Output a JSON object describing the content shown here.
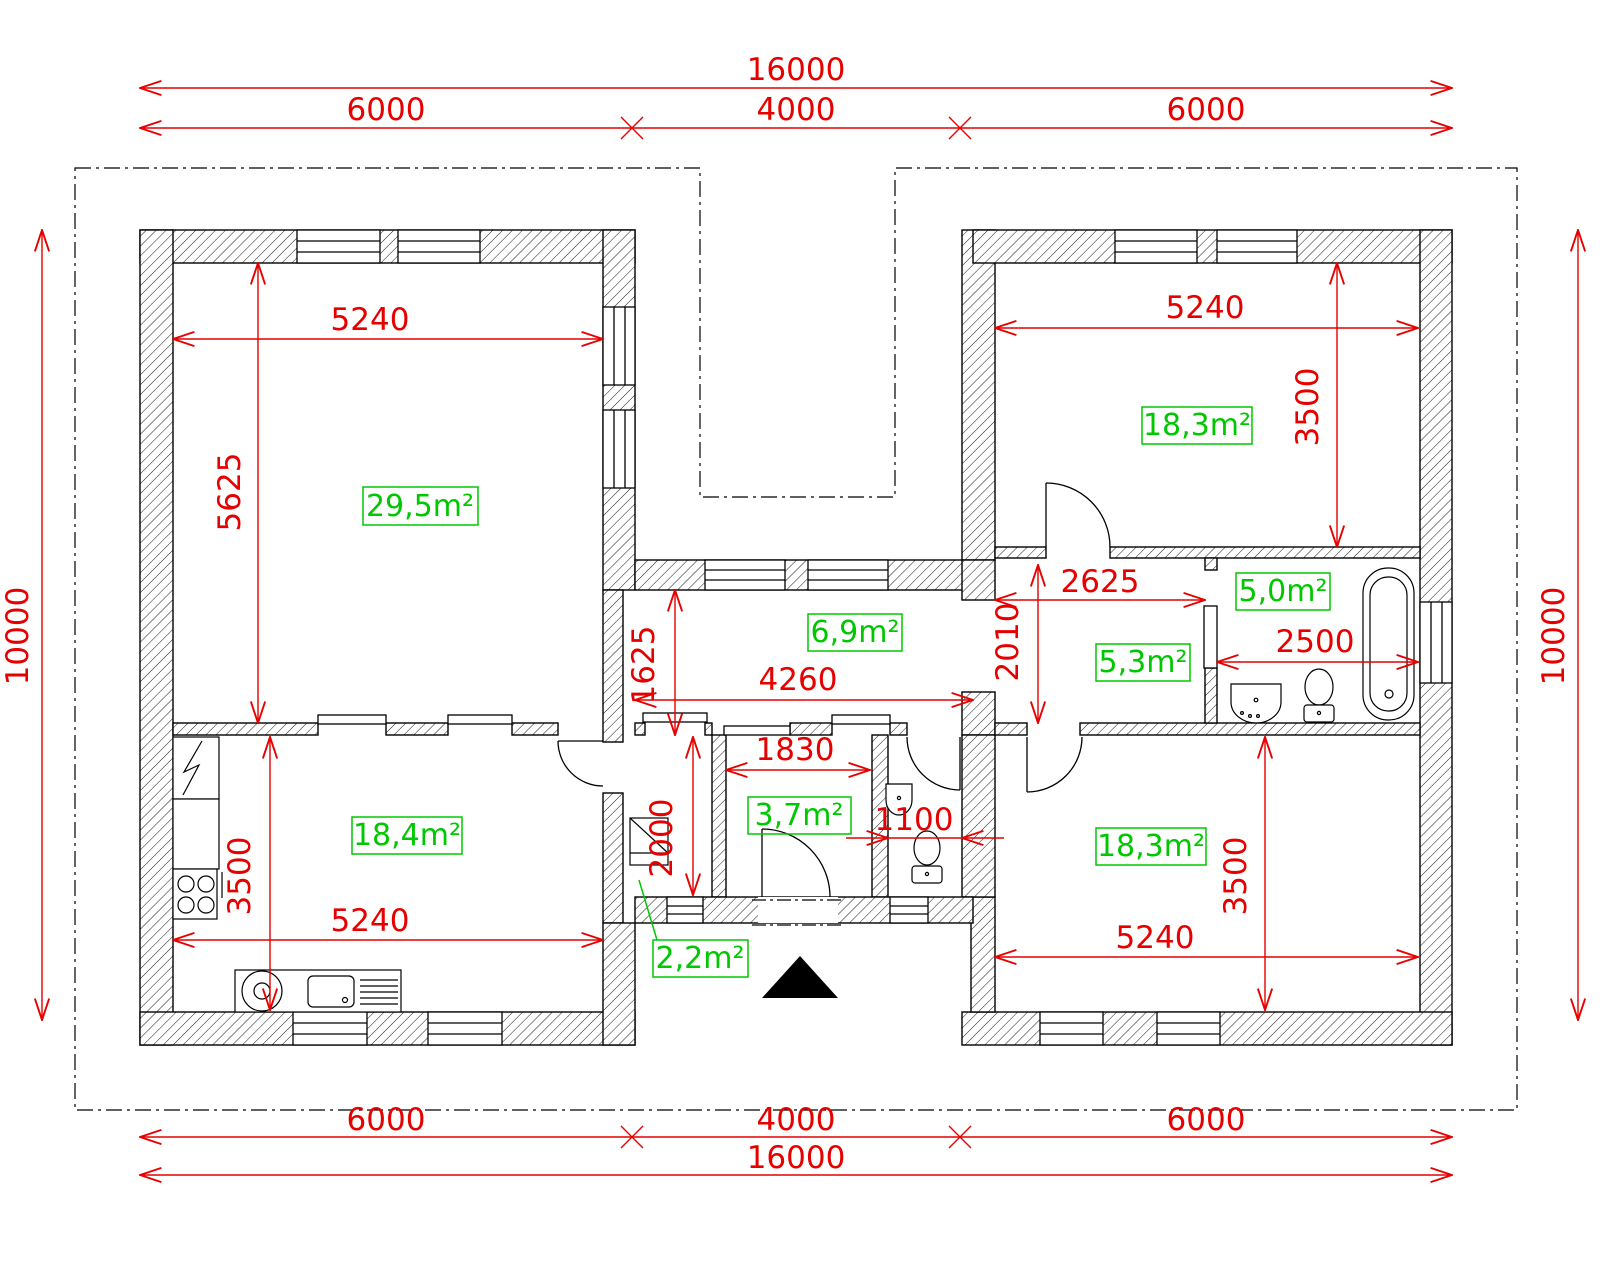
{
  "drawing_type": "house floor plan (CAD)",
  "outer_dims": {
    "total_width_top": "16000",
    "top_left": "6000",
    "top_center": "4000",
    "top_right": "6000",
    "bottom_left": "6000",
    "bottom_center": "4000",
    "bottom_right": "6000",
    "total_width_bottom": "16000",
    "total_height_left": "10000",
    "total_height_right": "10000"
  },
  "rooms": {
    "living": {
      "area": "29,5m²",
      "width": "5240",
      "height": "5625"
    },
    "bedroom_ne": {
      "area": "18,3m²",
      "width": "5240",
      "height": "3500"
    },
    "hallway": {
      "area": "6,9m²",
      "width": "4260",
      "height": "1625"
    },
    "inner_hall": {
      "area": "5,3m²",
      "width": "2625",
      "height": "2010"
    },
    "bathroom": {
      "area": "5,0m²",
      "width": "2500"
    },
    "kitchen": {
      "area": "18,4m²",
      "width": "5240",
      "height": "3500"
    },
    "vestibule": {
      "area": "3,7m²",
      "width": "1830"
    },
    "wc": {
      "width": "1100"
    },
    "closet": {
      "area": "2,2m²",
      "depth": "2000"
    },
    "bedroom_se": {
      "area": "18,3m²",
      "width": "5240",
      "height": "3500"
    }
  },
  "colors": {
    "dimension": "#e60000",
    "area_label": "#00c800",
    "walls": "#000000",
    "background": "#ffffff"
  }
}
